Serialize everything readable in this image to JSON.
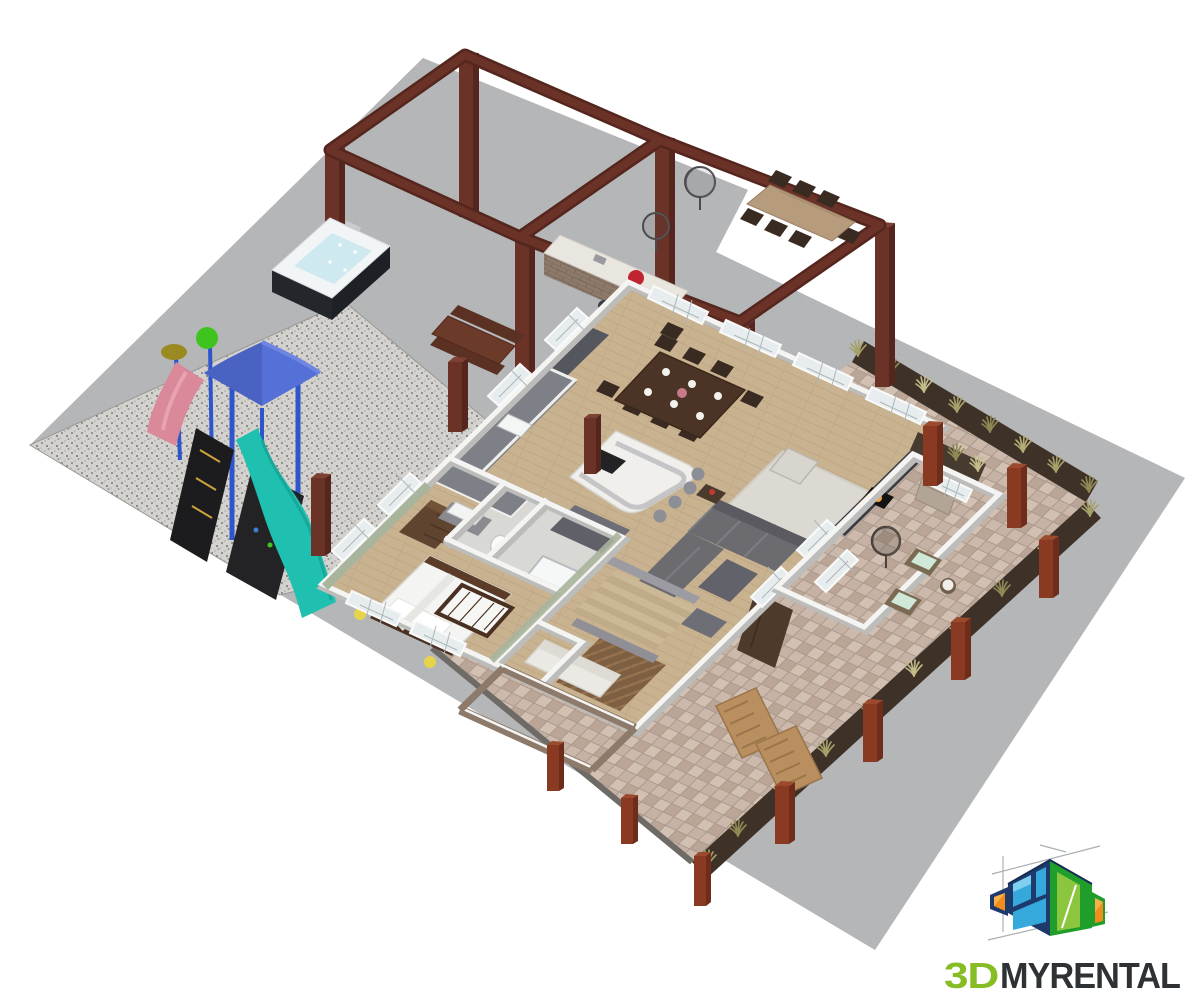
{
  "logo": {
    "text_green": "3D",
    "text_rest": "MYRENTAL",
    "full_name": "3DMYRENTAL",
    "green": "#86bd24",
    "dark": "#2e3234",
    "icon": {
      "navy": "#1e3a6d",
      "navy_edge": "#162c52",
      "sky": "#35a8dc",
      "sky_light": "#7fd0f0",
      "green_face": "#1f9e2c",
      "lime": "#8cc63e",
      "orange": "#f28c1c",
      "orange_light": "#f8b04a",
      "guide": "#aab0b4"
    }
  },
  "palette": {
    "background": "#ffffff",
    "concrete": "#b4b6b8",
    "gravel": "#d4d2ce",
    "paver": "#c6b2a4",
    "mulch": "#3e3228",
    "wood_floor": "#c9b28f",
    "herringbone": "#7f5f42",
    "tile": "#d8d8d4",
    "wall_top": "#f4f4f2",
    "wall_side": "#bcbcba",
    "green_wall": "#a9b49c",
    "pergola_wood": "#6b3227",
    "pergola_dark": "#54261e",
    "corten_post": "#8a3a22",
    "sofa_gray": "#6b6b70",
    "rug": "#dcd9d3",
    "dining_table": "#4b3425",
    "island_top": "#f0efec",
    "cabinet_gray": "#5a5c63",
    "stairs_wood": "#cbb896",
    "brick": "#8d7a6a",
    "hot_tub_base": "#23262b",
    "hot_tub_water": "#cfe9f0",
    "slide_teal": "#1fc0b0",
    "canopy_blue": "#5570d6",
    "slide_pink": "#d9899a",
    "grass": "#a6a06b",
    "white_sofa": "#ebe9e4"
  },
  "scene": {
    "description": "3D isometric cutaway floor plan of a vacation rental: pergola patio with outdoor kitchen and dining, hot tub, playground on gravel, open-plan kitchen/dining/living room, bedroom with crib, bathrooms, stairs, paver patio with ornamental grasses and corten posts",
    "areas": [
      "concrete-patio",
      "gravel-play-area",
      "paver-patio",
      "planting-beds",
      "main-floor"
    ]
  }
}
